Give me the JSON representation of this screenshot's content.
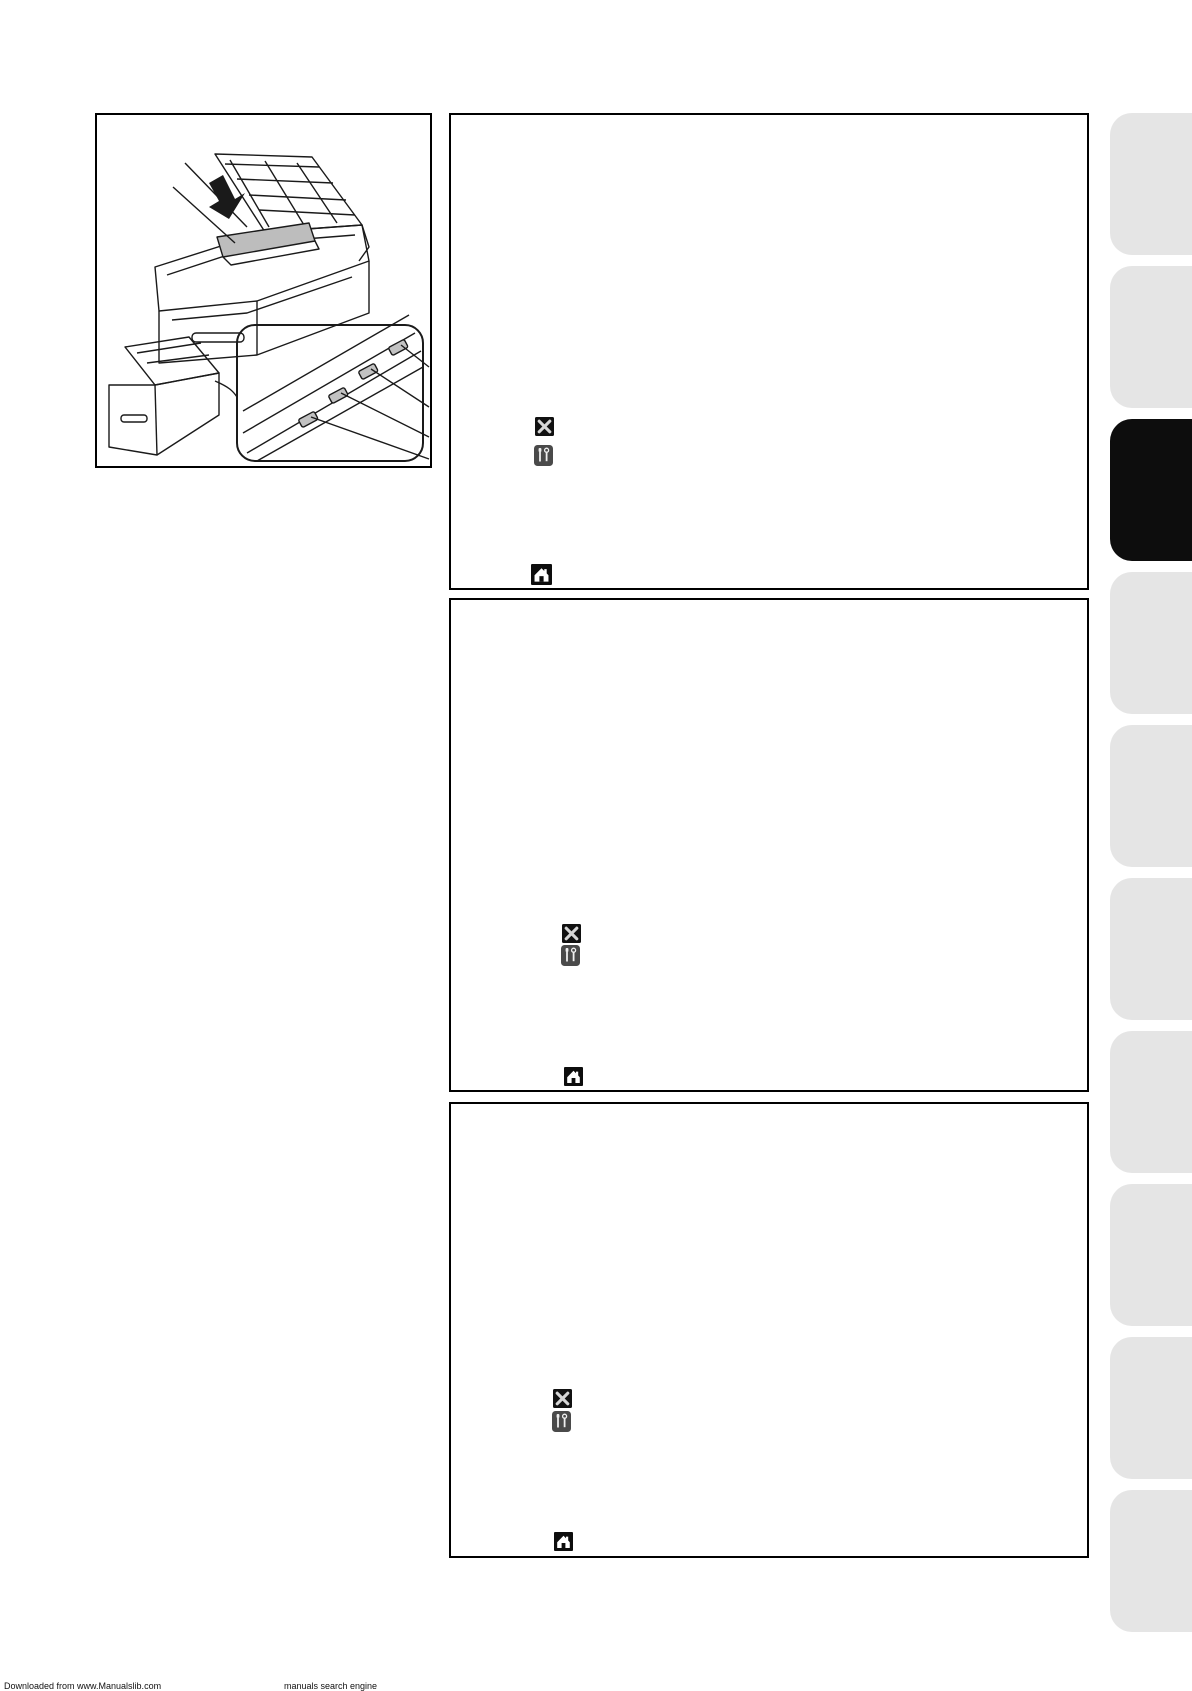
{
  "page": {
    "width": 1192,
    "height": 1685,
    "background": "#ffffff",
    "description": "Printer user-guide page: left framed line-art of printer maintenance, three blank instruction panels with small control-button icons, gray chapter tabs on right edge (third tab active)"
  },
  "figure": {
    "name": "printer-maintenance-illustration",
    "parts": [
      "printer-with-top-cover-open-and-toner-drum-assembly-being-inserted-with-arrow",
      "printer-with-magnified-callout-of-four-corona-wire-sliders-with-leader-lines"
    ]
  },
  "panels": [
    {
      "name": "step-panel-1",
      "icons": [
        {
          "glyph": "cancel-x",
          "bg": "#111111",
          "fg": "#d6d6d6"
        },
        {
          "glyph": "toolbox",
          "bg": "#4a4a4a",
          "fg": "#efefef"
        },
        {
          "glyph": "home",
          "bg": "#0d0d0d",
          "fg": "#ffffff"
        }
      ]
    },
    {
      "name": "step-panel-2",
      "icons": [
        {
          "glyph": "cancel-x",
          "bg": "#111111",
          "fg": "#d6d6d6"
        },
        {
          "glyph": "toolbox",
          "bg": "#4a4a4a",
          "fg": "#efefef"
        },
        {
          "glyph": "home",
          "bg": "#0d0d0d",
          "fg": "#ffffff"
        }
      ]
    },
    {
      "name": "step-panel-3",
      "icons": [
        {
          "glyph": "cancel-x",
          "bg": "#111111",
          "fg": "#d6d6d6"
        },
        {
          "glyph": "toolbox",
          "bg": "#4a4a4a",
          "fg": "#efefef"
        },
        {
          "glyph": "home",
          "bg": "#0d0d0d",
          "fg": "#ffffff"
        }
      ]
    }
  ],
  "tab_rail": {
    "inactive_color": "#e5e5e5",
    "active_color": "#0d0d0d",
    "tabs": [
      {
        "index": 1,
        "active": false
      },
      {
        "index": 2,
        "active": false
      },
      {
        "index": 3,
        "active": true
      },
      {
        "index": 4,
        "active": false
      },
      {
        "index": 5,
        "active": false
      },
      {
        "index": 6,
        "active": false
      },
      {
        "index": 7,
        "active": false
      },
      {
        "index": 8,
        "active": false
      },
      {
        "index": 9,
        "active": false
      },
      {
        "index": 10,
        "active": false
      }
    ]
  },
  "footer": {
    "left": "Downloaded from www.Manualslib.com",
    "right": "manuals search engine"
  }
}
